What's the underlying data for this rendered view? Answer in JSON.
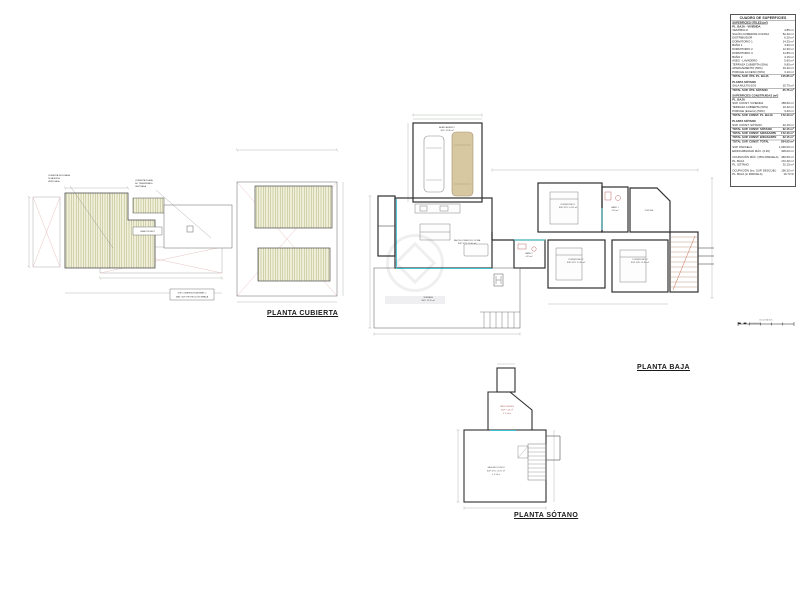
{
  "titles": {
    "cubierta": "PLANTA CUBIERTA",
    "baja": "PLANTA BAJA",
    "sotano": "PLANTA SÓTANO"
  },
  "colors": {
    "wall": "#2e2e2e",
    "dim_line": "#8f9e8f",
    "roof_hatch": "#a7b077",
    "roof_fill": "#f2efda",
    "cross_red": "#e7bcbc",
    "accent_cyan": "#3fc3d3",
    "fixture_red": "#b85c5c"
  },
  "roof": {
    "callout_left_1": "CUBIERTA INCLINADA",
    "callout_left_2": "TEJA MIXTA",
    "callout_left_3": "VENTILADA",
    "callout_right_1": "CUBIERTA PLANA",
    "callout_right_2": "NO TRANSITABLE",
    "callout_right_3": "LASTRADA",
    "box_label": "CASETÓN INST.",
    "note_1": "SUP. CUBIERTA TEJA PANEL 2",
    "note_2": "MÁX. SUP. PROYECCIÓN TAPADA"
  },
  "baja": {
    "garaje_1": "APARCAMIENTO",
    "garaje_2": "SUP: 32.80 m²",
    "salon_1": "SALÓN-COMEDOR-COCINA",
    "salon_2": "SUP. ÚTIL: 52.40 m²",
    "dorm1_1": "DORMITORIO 1",
    "dorm1_2": "SUP. ÚTIL: 14.25 m²",
    "bano1_1": "BAÑO 1",
    "bano1_2": "4.90 m²",
    "dorm2_1": "DORMITORIO 2",
    "dorm2_2": "SUP. ÚTIL: 12.30 m²",
    "dorm3_1": "DORMITORIO 3",
    "dorm3_2": "SUP. ÚTIL: 11.85 m²",
    "bano2_1": "BAÑO 2",
    "bano2_2": "4.15 m²",
    "terraza_1": "TERRAZA",
    "terraza_2": "SUP: 19.70 m²",
    "porche": "PORCHE",
    "scale_text": "0   1   2   3   4   5 m"
  },
  "sotano": {
    "patio_1": "PATIO INGLÉS",
    "patio_2": "SUP: 7.35 m²",
    "patio_3": "h: 2.50 m",
    "sala_1": "SALA MULTIUSOS",
    "sala_2": "SUP. ÚTIL: 25.75 m²",
    "sala_3": "h: 2.50 m"
  },
  "table": {
    "title": "CUADRO DE SUPERFICIES",
    "rows": [
      {
        "label": "SUPERFICIES ÚTILES (m²)",
        "value": "",
        "cls": "hdr"
      },
      {
        "label": "PL. BAJA · VIVIENDA",
        "value": "",
        "cls": "sub"
      },
      {
        "label": "VESTÍBULO",
        "value": "4.85 m²",
        "cls": ""
      },
      {
        "label": "SALÓN-COMEDOR-COCINA",
        "value": "52.40 m²",
        "cls": ""
      },
      {
        "label": "DISTRIBUIDOR",
        "value": "6.20 m²",
        "cls": ""
      },
      {
        "label": "DORMITORIO 1",
        "value": "14.25 m²",
        "cls": ""
      },
      {
        "label": "BAÑO 1",
        "value": "4.90 m²",
        "cls": ""
      },
      {
        "label": "DORMITORIO 2",
        "value": "12.30 m²",
        "cls": ""
      },
      {
        "label": "DORMITORIO 3",
        "value": "11.85 m²",
        "cls": ""
      },
      {
        "label": "BAÑO 2",
        "value": "4.15 m²",
        "cls": ""
      },
      {
        "label": "ASEO - LAVADERO",
        "value": "5.60 m²",
        "cls": ""
      },
      {
        "label": "TERRAZA CUBIERTA (50%)",
        "value": "9.85 m²",
        "cls": ""
      },
      {
        "label": "APARCAMIENTO (50%)",
        "value": "16.40 m²",
        "cls": ""
      },
      {
        "label": "PORCHE ACCESO (50%)",
        "value": "3.10 m²",
        "cls": ""
      },
      {
        "label": "TOTAL SUP. ÚTIL PL. BAJA",
        "value": "145.85 m²",
        "cls": "total"
      },
      {
        "label": "",
        "value": "",
        "cls": "gap"
      },
      {
        "label": "PLANTA SÓTANO",
        "value": "",
        "cls": "sub"
      },
      {
        "label": "SALA MULTIUSOS",
        "value": "25.75 m²",
        "cls": ""
      },
      {
        "label": "TOTAL SUP. ÚTIL SÓTANO",
        "value": "25.75 m²",
        "cls": "total"
      },
      {
        "label": "",
        "value": "",
        "cls": "gap"
      },
      {
        "label": "SUPERFICIES CONSTRUIDAS (m²)",
        "value": "",
        "cls": "hdr"
      },
      {
        "label": "PL. BAJA",
        "value": "",
        "cls": "sub"
      },
      {
        "label": "SUP. CONST. VIVIENDA",
        "value": "158.60 m²",
        "cls": ""
      },
      {
        "label": "TERRAZA CUBIERTA (50%)",
        "value": "10.40 m²",
        "cls": ""
      },
      {
        "label": "PORCHE (Exterior) (50%)",
        "value": "3.40 m²",
        "cls": ""
      },
      {
        "label": "TOTAL SUP. CONST. PL. BAJA",
        "value": "172.40 m²",
        "cls": "total"
      },
      {
        "label": "",
        "value": "",
        "cls": "gap"
      },
      {
        "label": "PLANTA SÓTANO",
        "value": "",
        "cls": "sub"
      },
      {
        "label": "SUP. CONST. SÓTANO",
        "value": "32.15 m²",
        "cls": ""
      },
      {
        "label": "TOTAL SUP. CONST. SÓTANO",
        "value": "32.15 m²",
        "cls": "total"
      },
      {
        "label": "TOTAL SUP. CONST. S/RASANTE",
        "value": "172.40 m²",
        "cls": "total"
      },
      {
        "label": "TOTAL SUP. CONST. B/RASANTE",
        "value": "32.15 m²",
        "cls": "total"
      },
      {
        "label": "TOTAL SUP. CONST. TOTAL",
        "value": "204.55 m²",
        "cls": "total"
      },
      {
        "label": "",
        "value": "",
        "cls": "gap"
      },
      {
        "label": "SUP. PARCELA",
        "value": "1,030.00 m²",
        "cls": ""
      },
      {
        "label": "EDIFICABILIDAD MÁX. (0.30)",
        "value": "309.00 m²",
        "cls": ""
      },
      {
        "label": "",
        "value": "",
        "cls": "gap"
      },
      {
        "label": "OCUPACIÓN MÁX. (35% PARCELA)",
        "value": "360.50 m²",
        "cls": ""
      },
      {
        "label": "PL. BAJA",
        "value": "172.40 m²",
        "cls": ""
      },
      {
        "label": "PL. SÓTANO",
        "value": "32.15 m²",
        "cls": ""
      },
      {
        "label": "",
        "value": "",
        "cls": "gap"
      },
      {
        "label": "OCUPACIÓN (Inc. SUP. DESCUB.)",
        "value": "196.20 m²",
        "cls": ""
      },
      {
        "label": "PL. BAJA (s/ PARCELA)",
        "value": "16.73 %",
        "cls": ""
      }
    ]
  }
}
